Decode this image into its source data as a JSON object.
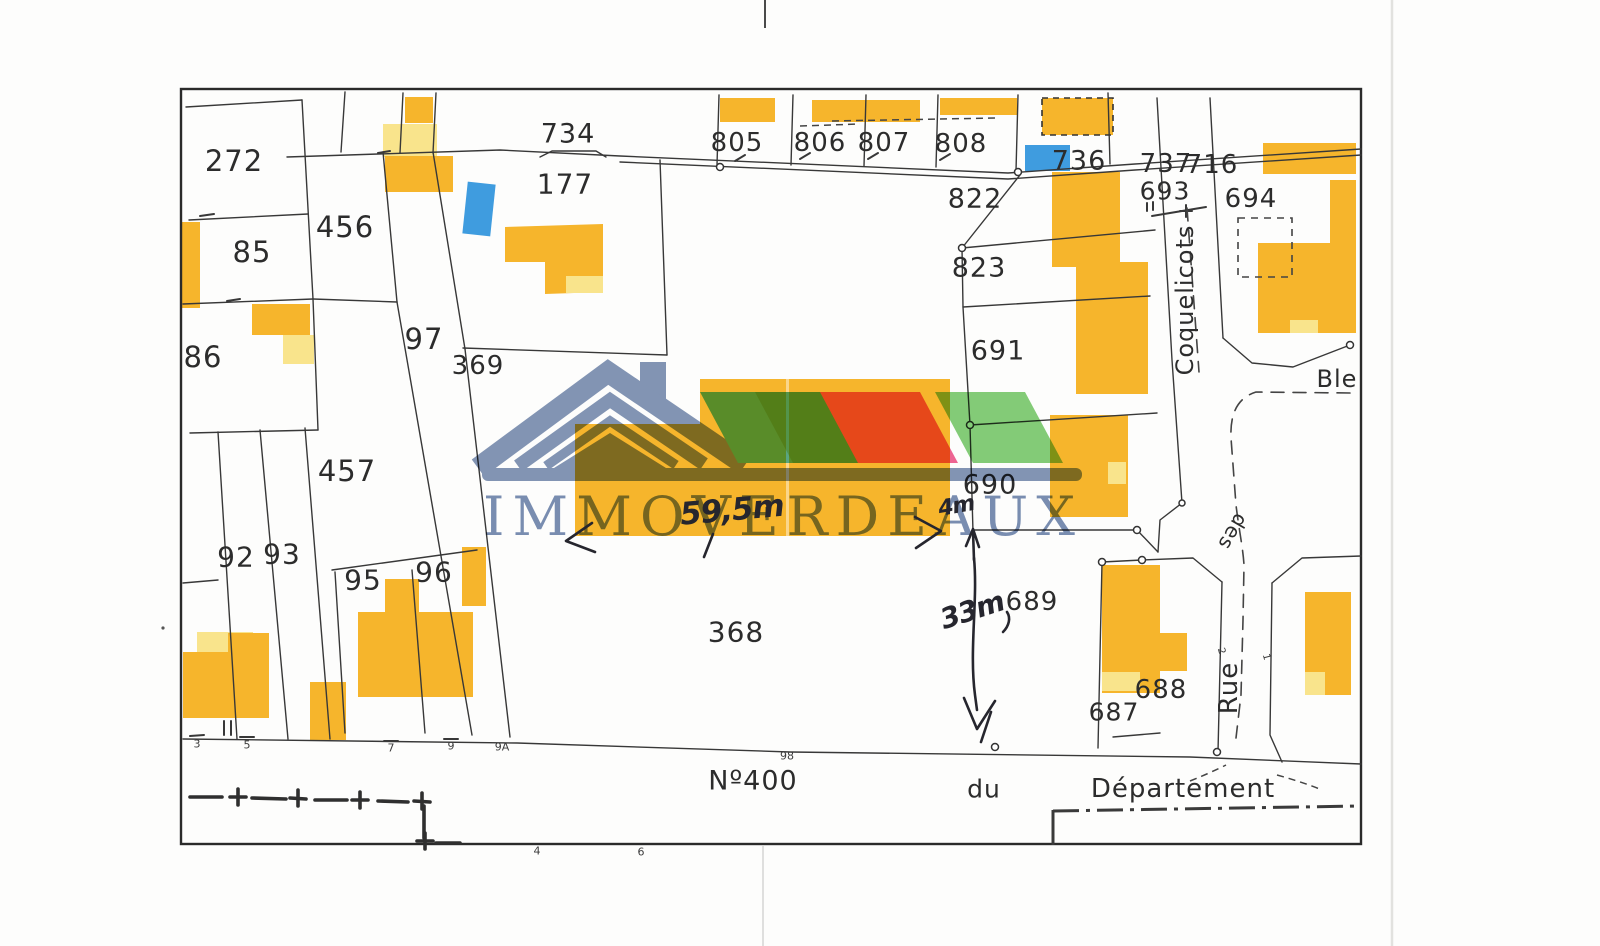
{
  "parcels": {
    "n272": "272",
    "n85": "85",
    "n86": "86",
    "n456": "456",
    "n97": "97",
    "n369": "369",
    "n457": "457",
    "n92": "92",
    "n93": "93",
    "n95": "95",
    "n96": "96",
    "n177": "177",
    "n734": "734",
    "n805": "805",
    "n806": "806",
    "n807": "807",
    "n808": "808",
    "n736": "736",
    "n737": "737",
    "n716": "716",
    "n693": "693",
    "n694": "694",
    "n822": "822",
    "n823": "823",
    "n691": "691",
    "n690": "690",
    "n689": "689",
    "n688": "688",
    "n687": "687",
    "n368": "368"
  },
  "streets": {
    "coquelicots": "Coquelicots",
    "des": "des",
    "rue": "Rue",
    "bleuets_partial": "Ble"
  },
  "road_labels": {
    "number": "Nº400",
    "du": "du",
    "departement": "Département"
  },
  "edge_ticks": {
    "t3": "3",
    "t5": "5",
    "t7": "7",
    "t9": "9",
    "t9a": "9A",
    "t98": "98",
    "t4": "4",
    "t6": "6"
  },
  "house_numbers": {
    "h2": "2",
    "h1": "1"
  },
  "handwritten": {
    "frontage": "59,5m",
    "side_gap": "4m",
    "depth": "33m"
  },
  "logo": {
    "brand": "IMMOVERDEAUX"
  },
  "palette": {
    "building_gold": "#F6B52C",
    "building_light_yellow": "#F9E48C",
    "pool_blue": "#3F9CDF",
    "logo_slate": "#7E91B2",
    "logo_text_blue": "#7489AF",
    "stripe_skyblue": "#55C3EE",
    "stripe_teal": "#4FAE86",
    "stripe_pink": "#EF5F90",
    "stripe_green": "#7FCB72",
    "map_ink": "#2C2C2C"
  }
}
